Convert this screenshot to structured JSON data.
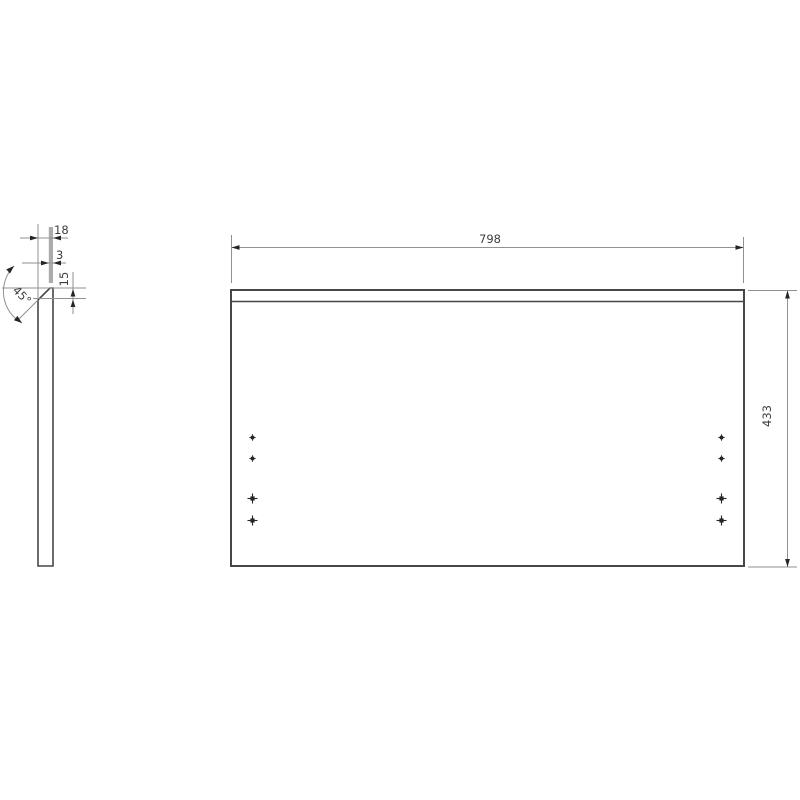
{
  "drawing": {
    "kind": "technical-panel-drawing",
    "front_view": {
      "width_label": "798",
      "height_label": "433"
    },
    "side_view": {
      "thickness_label": "18",
      "edge_flat_label": "3",
      "chamfer_depth_label": "15",
      "chamfer_angle_label": "45°"
    },
    "hole_markers": {
      "columns_x": [
        252.5,
        721.5
      ],
      "small_rows_y": [
        437.5,
        458.5
      ],
      "large_rows_y": [
        498.5,
        520.5
      ]
    },
    "colors": {
      "outline": "#474747",
      "dimension_line": "#929292",
      "arrow": "#262626",
      "text": "#3d3d3d",
      "edge_band": "#ababab",
      "background": "#ffffff"
    }
  }
}
